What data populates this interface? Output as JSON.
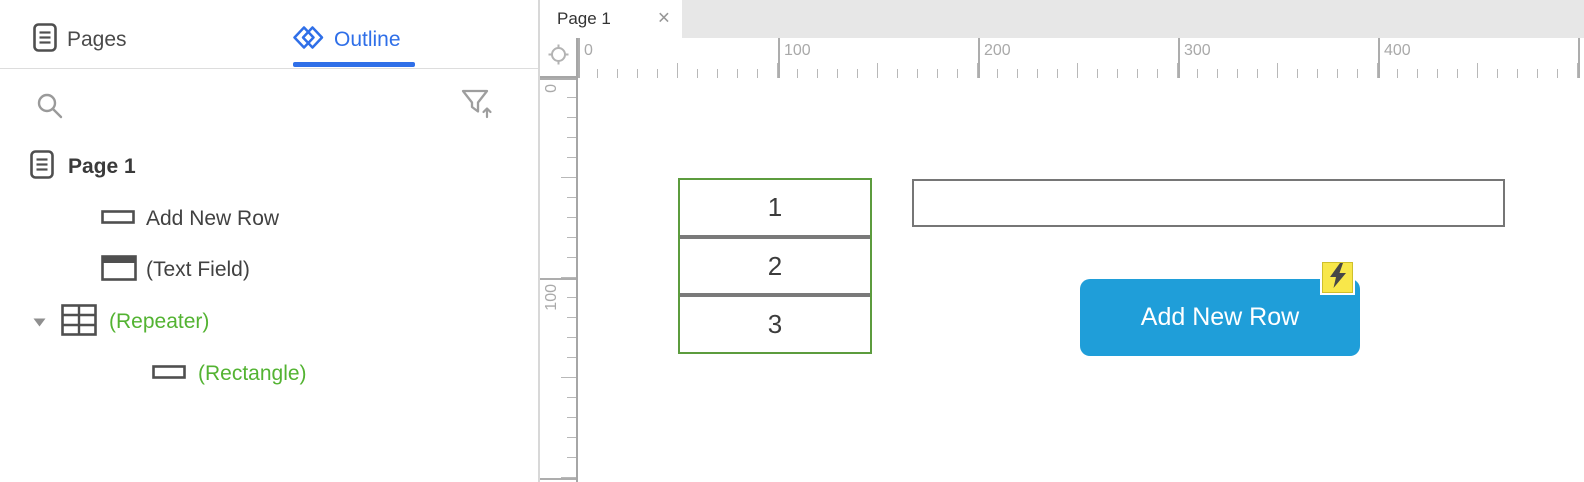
{
  "left_panel": {
    "tabs": [
      {
        "label": "Pages",
        "icon": "pages-icon",
        "active": false
      },
      {
        "label": "Outline",
        "icon": "outline-icon",
        "active": true
      }
    ],
    "tree": [
      {
        "label": "Page 1",
        "icon": "page-icon",
        "level": 0,
        "style": "bold"
      },
      {
        "label": "Add New Row",
        "icon": "button-widget-icon",
        "level": 1,
        "style": "normal"
      },
      {
        "label": "(Text Field)",
        "icon": "text-field-icon",
        "level": 1,
        "style": "normal"
      },
      {
        "label": "(Repeater)",
        "icon": "repeater-icon",
        "level": 1,
        "style": "green",
        "expanded": true
      },
      {
        "label": "(Rectangle)",
        "icon": "rectangle-icon",
        "level": 2,
        "style": "green"
      }
    ]
  },
  "canvas": {
    "tab": {
      "label": "Page 1",
      "close": "×"
    },
    "zoom_scale": "200%",
    "rulers": {
      "horizontal_labels": [
        "0",
        "100",
        "200",
        "300",
        "400"
      ],
      "vertical_labels": [
        "0",
        "100"
      ]
    },
    "widgets": {
      "repeater": {
        "rows": [
          "1",
          "2",
          "3"
        ]
      },
      "text_field": {
        "value": "",
        "placeholder": ""
      },
      "button": {
        "label": "Add New Row",
        "has_interaction_badge": true
      }
    }
  },
  "colors": {
    "accent_blue": "#2f6fe8",
    "outline_green": "#53b332",
    "button_blue": "#1f9ed9",
    "badge_yellow": "#f8e74a",
    "repeater_border": "#5c9c3e",
    "separator_gray": "#7a7a7a"
  }
}
